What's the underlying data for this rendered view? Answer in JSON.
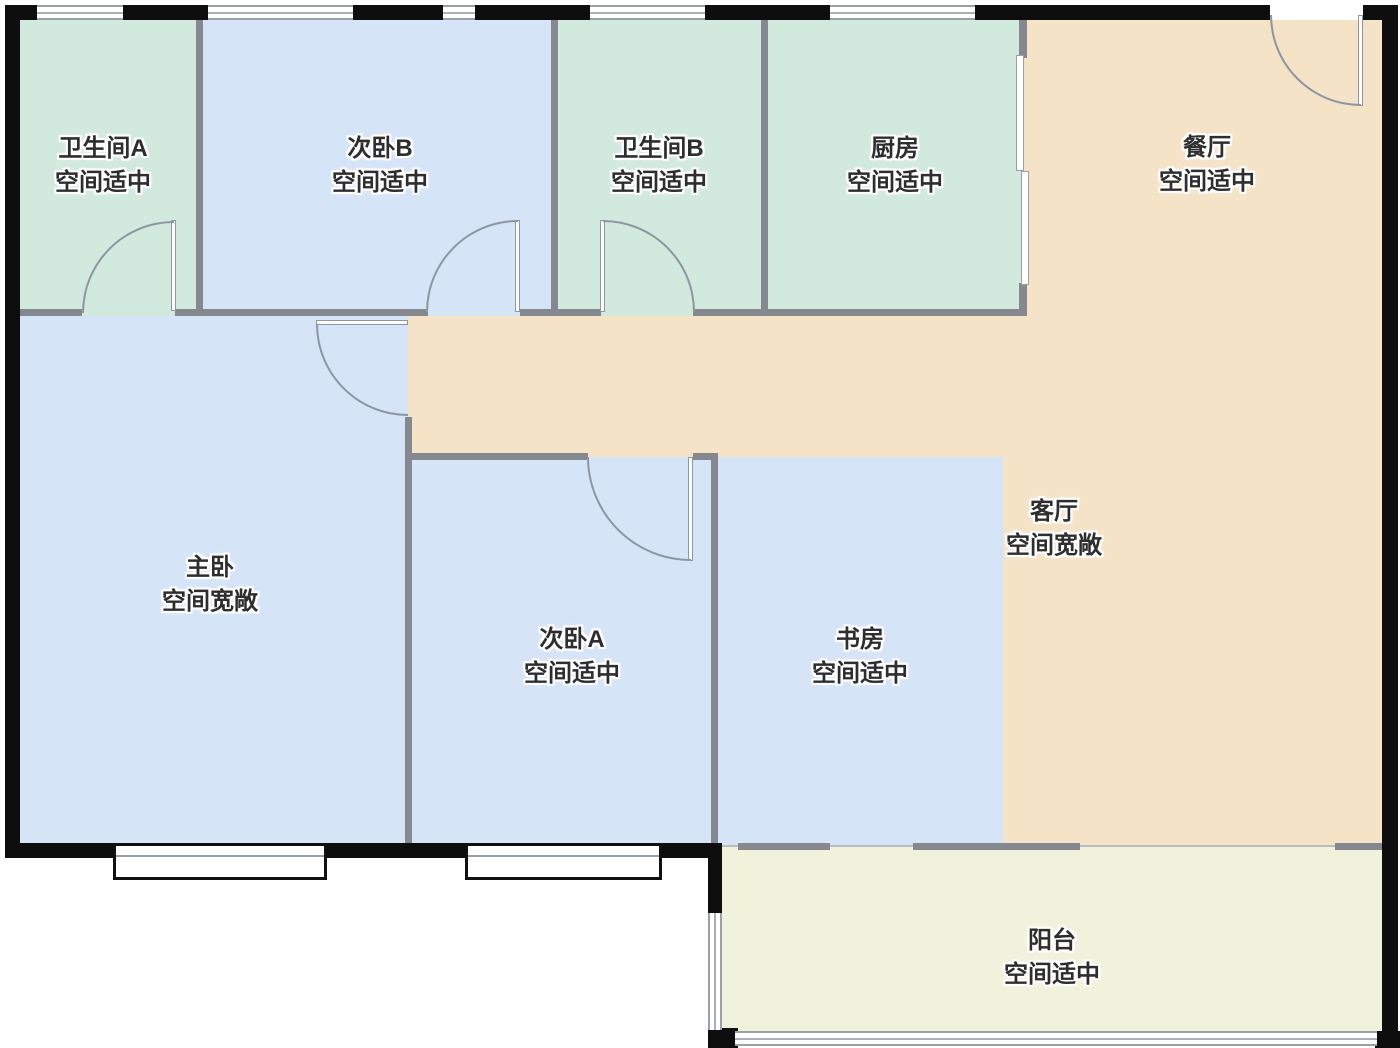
{
  "floorplan": {
    "rooms": [
      {
        "name": "卫生间A",
        "status": "空间适中",
        "zone": "bathroom-a",
        "fill": "#d2e9dd"
      },
      {
        "name": "次卧B",
        "status": "空间适中",
        "zone": "bedroom-b",
        "fill": "#d6e4f8"
      },
      {
        "name": "卫生间B",
        "status": "空间适中",
        "zone": "bathroom-b",
        "fill": "#d2e9dd"
      },
      {
        "name": "厨房",
        "status": "空间适中",
        "zone": "kitchen",
        "fill": "#d2e9dd"
      },
      {
        "name": "餐厅",
        "status": "空间适中",
        "zone": "dining-room",
        "fill": "#f5e3c8"
      },
      {
        "name": "主卧",
        "status": "空间宽敞",
        "zone": "master-bedroom",
        "fill": "#d6e4f8"
      },
      {
        "name": "次卧A",
        "status": "空间适中",
        "zone": "bedroom-a",
        "fill": "#d6e4f8"
      },
      {
        "name": "书房",
        "status": "空间适中",
        "zone": "study",
        "fill": "#d6e4f8"
      },
      {
        "name": "客厅",
        "status": "空间宽敞",
        "zone": "living-room",
        "fill": "#f5e3c8"
      },
      {
        "name": "阳台",
        "status": "空间适中",
        "zone": "balcony",
        "fill": "#f1f2dc"
      }
    ],
    "colors": {
      "wet_room_green": "#d2e9dd",
      "bedroom_blue": "#d6e4f8",
      "living_dining_tan": "#f5e3c8",
      "balcony_yellow": "#f1f2dc",
      "interior_wall_gray": "#85888e",
      "exterior_wall_black": "#0e0e0e",
      "door_arc_gray": "#8d96a3",
      "label_text": "#2e2e2e"
    }
  }
}
